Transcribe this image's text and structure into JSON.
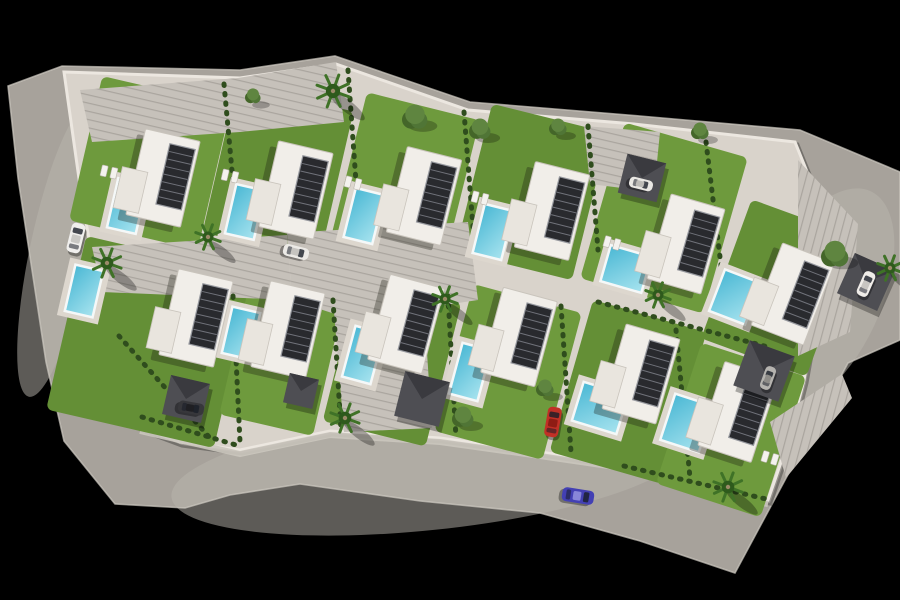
{
  "scene": {
    "description": "aerial-3d-render-villa-development-site-plan",
    "canvas": {
      "width": 900,
      "height": 600,
      "background": "#000000"
    },
    "colors": {
      "road": "#a7a29b",
      "roadGlow": "#bab5ad",
      "curb": "#cfcac2",
      "pavement": "#d9d3cb",
      "stripe": "rgba(70,65,58,0.22)",
      "lawn": "#6e9a3d",
      "lawnAlt": "#648f36",
      "hedge": "#2f4d1d",
      "poolA": "#4db9d5",
      "poolB": "#a5e2ee",
      "poolRim": "#f5f8f8",
      "deck": "#ddd7ce",
      "villa": "#f1eee9",
      "villaEdge": "#c9c4bc",
      "wing": "#e9e5de",
      "shadow": "rgba(25,25,15,0.32)",
      "panel": "#292a2e",
      "panelLine": "#70727a",
      "panelFrame": "#97999f",
      "pergola": "#4e4e53",
      "pergolaDark": "#3a3a3f",
      "frond": "#3f7227",
      "frondDark": "#2e5a1c",
      "trunk": "#9b8a68",
      "treeA": "#507536",
      "treeB": "#5f8540",
      "treeC": "#446629",
      "wall": "#ece7e0",
      "walk": "#cbc6be",
      "lounger": "#f4f2ee"
    },
    "outline": {
      "outer": [
        [
          8,
          86
        ],
        [
          62,
          66
        ],
        [
          240,
          70
        ],
        [
          335,
          56
        ],
        [
          470,
          102
        ],
        [
          640,
          116
        ],
        [
          800,
          130
        ],
        [
          900,
          172
        ],
        [
          900,
          340
        ],
        [
          848,
          363
        ],
        [
          735,
          573
        ],
        [
          640,
          541
        ],
        [
          540,
          513
        ],
        [
          420,
          501
        ],
        [
          300,
          484
        ],
        [
          230,
          495
        ],
        [
          185,
          508
        ],
        [
          115,
          504
        ],
        [
          64,
          441
        ],
        [
          46,
          362
        ],
        [
          18,
          178
        ]
      ],
      "parcel": [
        [
          64,
          72
        ],
        [
          240,
          78
        ],
        [
          336,
          64
        ],
        [
          468,
          110
        ],
        [
          634,
          124
        ],
        [
          795,
          142
        ],
        [
          812,
          184
        ],
        [
          826,
          252
        ],
        [
          818,
          302
        ],
        [
          804,
          380
        ],
        [
          788,
          442
        ],
        [
          768,
          500
        ],
        [
          700,
          488
        ],
        [
          622,
          464
        ],
        [
          540,
          452
        ],
        [
          440,
          438
        ],
        [
          330,
          431
        ],
        [
          240,
          450
        ],
        [
          180,
          442
        ],
        [
          140,
          427
        ],
        [
          119,
          371
        ],
        [
          100,
          300
        ],
        [
          82,
          200
        ]
      ],
      "walkPath": [
        [
          140,
          431
        ],
        [
          240,
          454
        ],
        [
          330,
          435
        ],
        [
          440,
          442
        ],
        [
          540,
          456
        ],
        [
          622,
          468
        ],
        [
          700,
          492
        ],
        [
          768,
          504
        ]
      ]
    },
    "roadHighlights": [
      [
        430,
        470,
        260,
        60,
        -6
      ],
      [
        60,
        250,
        30,
        150,
        12
      ],
      [
        820,
        300,
        60,
        120,
        25
      ]
    ],
    "lawns": [
      [
        150,
        163,
        132,
        148,
        13,
        0
      ],
      [
        278,
        172,
        120,
        152,
        13,
        1
      ],
      [
        405,
        180,
        116,
        152,
        14,
        0
      ],
      [
        532,
        192,
        120,
        152,
        14,
        1
      ],
      [
        664,
        218,
        128,
        162,
        16,
        0
      ],
      [
        779,
        288,
        112,
        148,
        20,
        1
      ],
      [
        150,
        342,
        172,
        178,
        13,
        1
      ],
      [
        282,
        356,
        96,
        142,
        13,
        0
      ],
      [
        392,
        362,
        106,
        148,
        14,
        1
      ],
      [
        508,
        372,
        112,
        152,
        15,
        0
      ],
      [
        628,
        392,
        118,
        158,
        16,
        1
      ],
      [
        731,
        430,
        110,
        148,
        18,
        0
      ]
    ],
    "paved": [
      {
        "name": "upper-forecourt",
        "pattern": "A",
        "pts": [
          [
            80,
            90
          ],
          [
            238,
            78
          ],
          [
            336,
            62
          ],
          [
            344,
            122
          ],
          [
            240,
            132
          ],
          [
            92,
            142
          ]
        ]
      },
      {
        "name": "court-entry",
        "pattern": "A",
        "pts": [
          [
            92,
            247
          ],
          [
            287,
            235
          ],
          [
            292,
            300
          ],
          [
            102,
            292
          ]
        ]
      },
      {
        "name": "central-court",
        "pattern": "A",
        "pts": [
          [
            287,
            233
          ],
          [
            468,
            222
          ],
          [
            478,
            300
          ],
          [
            425,
            308
          ],
          [
            332,
            313
          ],
          [
            292,
            300
          ]
        ]
      },
      {
        "name": "court-south-arm",
        "pattern": "A",
        "pts": [
          [
            334,
            312
          ],
          [
            424,
            307
          ],
          [
            432,
            428
          ],
          [
            344,
            432
          ]
        ]
      },
      {
        "name": "parking-top-right",
        "pattern": "A",
        "pts": [
          [
            584,
            126
          ],
          [
            660,
            132
          ],
          [
            654,
            192
          ],
          [
            590,
            184
          ]
        ]
      },
      {
        "name": "parking-right-edge",
        "pattern": "B",
        "pts": [
          [
            798,
            160
          ],
          [
            858,
            224
          ],
          [
            850,
            332
          ],
          [
            798,
            356
          ]
        ]
      },
      {
        "name": "steps-bottom-right",
        "pattern": "B",
        "pts": [
          [
            770,
            422
          ],
          [
            842,
            374
          ],
          [
            852,
            398
          ],
          [
            786,
            478
          ]
        ]
      }
    ],
    "hedges": [
      [
        224,
        84,
        238,
        236
      ],
      [
        348,
        70,
        360,
        238
      ],
      [
        464,
        112,
        474,
        240
      ],
      [
        588,
        126,
        598,
        250
      ],
      [
        706,
        142,
        724,
        290
      ],
      [
        233,
        296,
        240,
        442
      ],
      [
        333,
        300,
        341,
        430
      ],
      [
        448,
        296,
        456,
        438
      ],
      [
        561,
        306,
        571,
        452
      ],
      [
        676,
        330,
        690,
        478
      ],
      [
        598,
        302,
        768,
        347
      ],
      [
        142,
        417,
        236,
        445
      ],
      [
        624,
        466,
        766,
        499
      ],
      [
        119,
        336,
        210,
        438
      ]
    ],
    "pools": [
      [
        127,
        206,
        27,
        48,
        13
      ],
      [
        245,
        212,
        27,
        48,
        13
      ],
      [
        364,
        216,
        27,
        48,
        14
      ],
      [
        493,
        232,
        27,
        48,
        14
      ],
      [
        626,
        269,
        40,
        35,
        16
      ],
      [
        735,
        297,
        36,
        42,
        21
      ],
      [
        84,
        291,
        26,
        45,
        13
      ],
      [
        241,
        333,
        26,
        45,
        13
      ],
      [
        363,
        355,
        27,
        50,
        15
      ],
      [
        470,
        372,
        27,
        50,
        15
      ],
      [
        600,
        408,
        44,
        38,
        17
      ],
      [
        687,
        423,
        38,
        46,
        18
      ]
    ],
    "villas": [
      [
        163,
        178,
        13
      ],
      [
        296,
        190,
        13
      ],
      [
        424,
        196,
        14
      ],
      [
        552,
        211,
        14
      ],
      [
        686,
        244,
        16
      ],
      [
        793,
        294,
        21
      ],
      [
        196,
        318,
        13
      ],
      [
        288,
        330,
        13
      ],
      [
        406,
        324,
        15
      ],
      [
        519,
        337,
        15
      ],
      [
        641,
        374,
        16
      ],
      [
        738,
        412,
        18
      ]
    ],
    "villaSize": {
      "w": 56,
      "h": 88,
      "panelW": 26,
      "panelH": 62,
      "panelDx": 12,
      "panelDy": -4
    },
    "pergolas": [
      [
        186,
        399,
        40,
        13
      ],
      [
        301,
        391,
        30,
        13
      ],
      [
        422,
        399,
        46,
        14
      ],
      [
        764,
        371,
        48,
        20
      ],
      [
        866,
        282,
        44,
        24
      ],
      [
        642,
        178,
        40,
        14
      ]
    ],
    "palms": [
      [
        107,
        263,
        15
      ],
      [
        208,
        237,
        13
      ],
      [
        333,
        91,
        17
      ],
      [
        445,
        299,
        13
      ],
      [
        345,
        418,
        15
      ],
      [
        658,
        295,
        13
      ],
      [
        728,
        487,
        15
      ],
      [
        890,
        268,
        13
      ]
    ],
    "trees": [
      [
        415,
        117,
        13
      ],
      [
        480,
        129,
        11
      ],
      [
        558,
        127,
        9
      ],
      [
        835,
        254,
        14
      ],
      [
        463,
        417,
        11
      ],
      [
        545,
        388,
        9
      ],
      [
        253,
        96,
        8
      ],
      [
        700,
        131,
        9
      ]
    ],
    "loungers": [
      [
        109,
        172,
        13
      ],
      [
        230,
        176,
        13
      ],
      [
        353,
        183,
        14
      ],
      [
        480,
        198,
        14
      ],
      [
        612,
        243,
        16
      ],
      [
        770,
        458,
        17
      ]
    ],
    "cars": [
      {
        "name": "white-car-left-road",
        "x": 76,
        "y": 238,
        "rot": 14,
        "len": 30,
        "wid": 14,
        "body": "#f0efed",
        "roof": "#c9c8c5"
      },
      {
        "name": "white-car-central-court",
        "x": 296,
        "y": 252,
        "rot": 104,
        "len": 26,
        "wid": 12,
        "body": "#eceae6",
        "roof": "#c6c4c0"
      },
      {
        "name": "gray-car-carport",
        "x": 768,
        "y": 378,
        "rot": 20,
        "len": 24,
        "wid": 11,
        "body": "#b5b3af",
        "roof": "#8e8c88"
      },
      {
        "name": "white-car-top-carport",
        "x": 641,
        "y": 184,
        "rot": 104,
        "len": 24,
        "wid": 11,
        "body": "#e9e7e3",
        "roof": "#bdbbb7"
      },
      {
        "name": "white-car-right-carport",
        "x": 866,
        "y": 284,
        "rot": 24,
        "len": 26,
        "wid": 12,
        "body": "#efece8",
        "roof": "#c8c5c1"
      },
      {
        "name": "red-car-driveway",
        "x": 553,
        "y": 422,
        "rot": 10,
        "len": 30,
        "wid": 14,
        "body": "#c13026",
        "roof": "#8e1c14"
      },
      {
        "name": "blue-car-south-road",
        "x": 578,
        "y": 496,
        "rot": 99,
        "len": 32,
        "wid": 14,
        "body": "#4340b4",
        "roof": "#8886d8"
      },
      {
        "name": "dark-car-bottom-left",
        "x": 191,
        "y": 408,
        "rot": 100,
        "len": 26,
        "wid": 12,
        "body": "#37373b",
        "roof": "#1f1f23"
      }
    ]
  }
}
